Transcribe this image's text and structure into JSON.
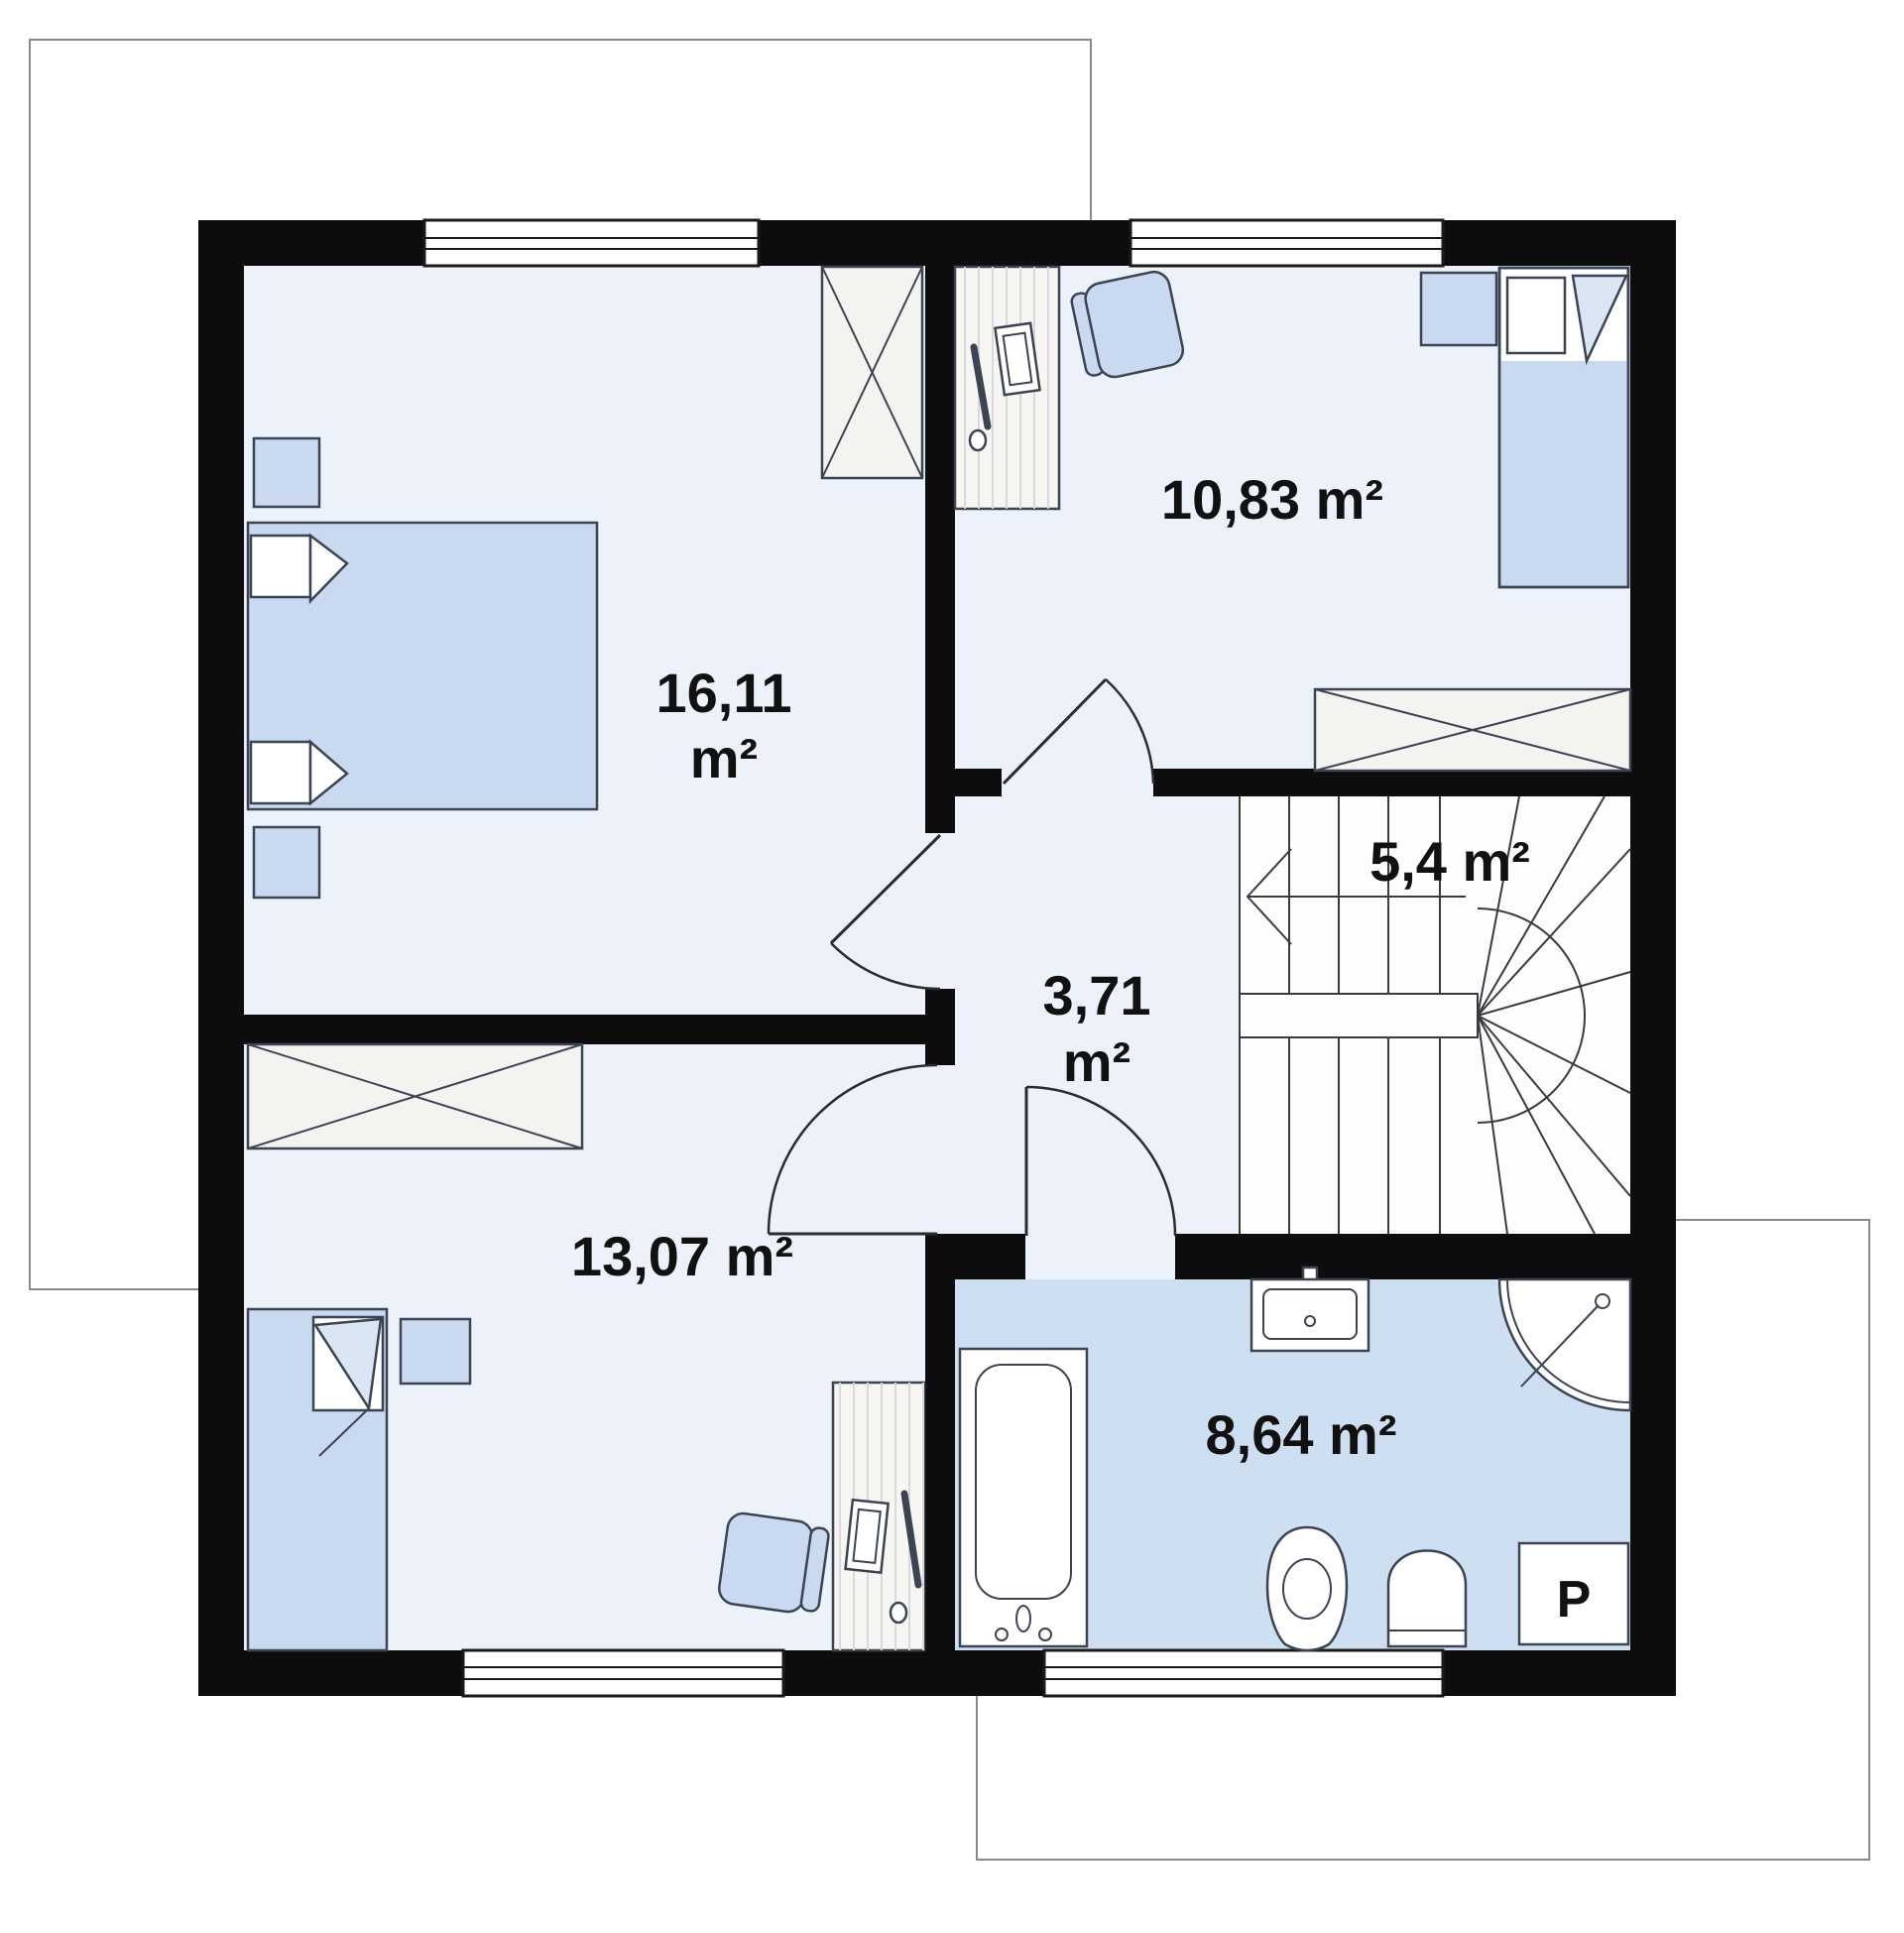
{
  "plan": {
    "wall_color": "#0d0d0d",
    "sheet_border": "#8a8a8a",
    "room_fill": "#edf1f9",
    "stairs_fill": "#fdfdfe",
    "bathroom_fill": "#cfdff2",
    "furniture_fill": "#c9daf0",
    "wardrobe_fill": "#f3f3f0",
    "desk_fill": "#f7f6f2",
    "rooms": [
      {
        "id": "bedroom-main",
        "area_value": "16,11",
        "area_unit": "m²"
      },
      {
        "id": "bedroom-right",
        "area_label": "10,83 m²"
      },
      {
        "id": "staircase",
        "area_label": "5,4 m²"
      },
      {
        "id": "hallway",
        "area_value": "3,71",
        "area_unit": "m²"
      },
      {
        "id": "bedroom-lower",
        "area_label": "13,07 m²"
      },
      {
        "id": "bathroom",
        "area_label": "8,64 m²"
      }
    ],
    "washing_machine_label": "P"
  }
}
